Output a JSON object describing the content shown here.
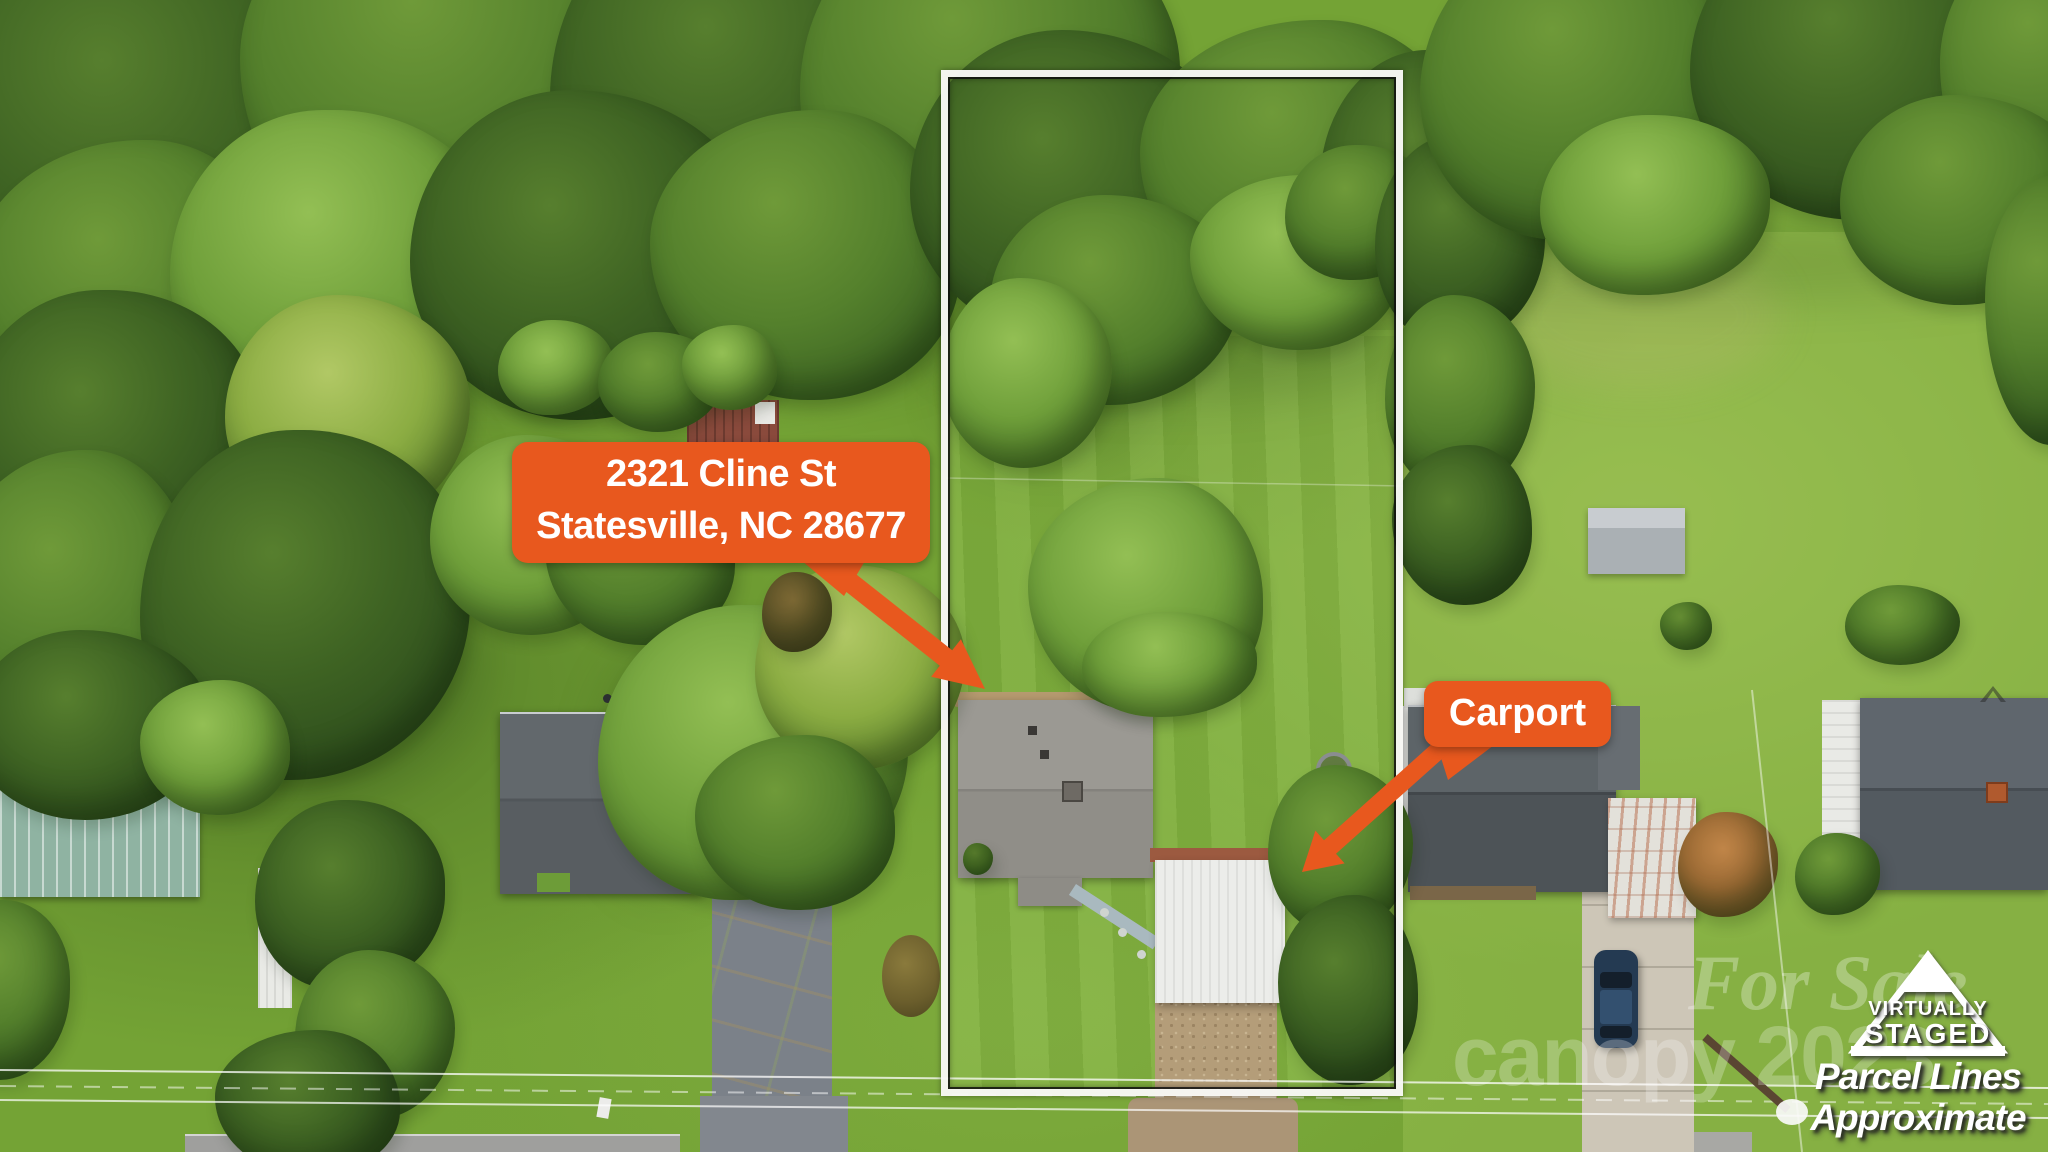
{
  "colors": {
    "callout_orange": "#E8581E",
    "callout_text": "#FFFFFF",
    "parcel_line_outer": "#FAFAF7",
    "parcel_line_inner": "#0F0F0F",
    "watermark_white": "#FFFFFF"
  },
  "callouts": {
    "address": {
      "line1": "2321 Cline St",
      "line2": "Statesville, NC 28677"
    },
    "carport": {
      "label": "Carport"
    }
  },
  "watermarks": {
    "staged_logo": {
      "line1": "VIRTUALLY",
      "line2": "STAGED"
    },
    "parcel_note": {
      "line1": "Parcel Lines",
      "line2": "Approximate"
    },
    "faint_for_sale": "For Sale",
    "faint_canopy": "canopy 2023"
  }
}
